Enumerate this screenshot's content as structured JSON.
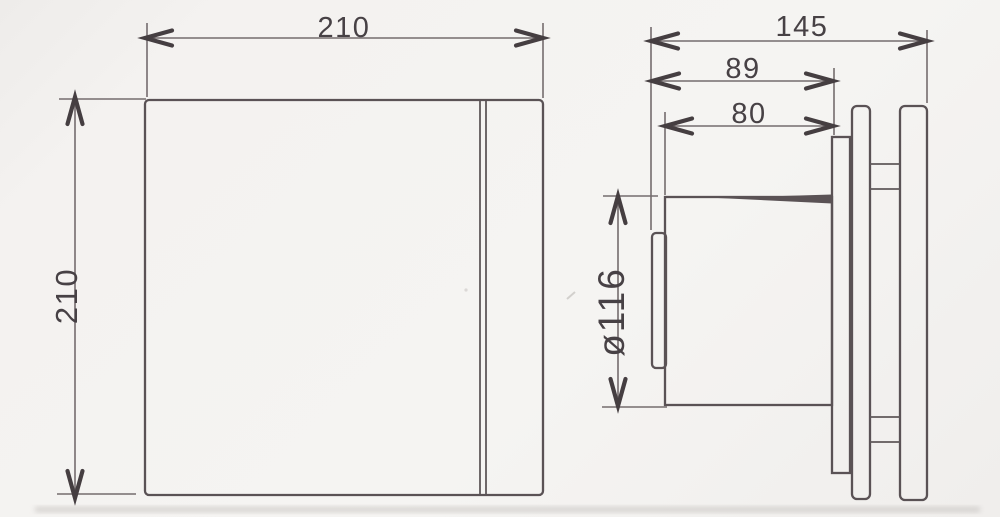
{
  "drawing": {
    "type": "technical-dimension-drawing",
    "subject": "extractor-fan-front-and-side-view",
    "front_view": {
      "width_label": "210",
      "height_label": "210"
    },
    "side_view": {
      "overall_depth_label": "145",
      "depth_to_flange_label": "89",
      "spigot_length_label": "80",
      "spigot_diameter_label": "ø116"
    },
    "colors": {
      "background": "#f4f2f0",
      "object_line": "#5a5255",
      "dimension_line": "#746c6e",
      "arrowhead": "#453e41",
      "text": "#474145"
    }
  }
}
